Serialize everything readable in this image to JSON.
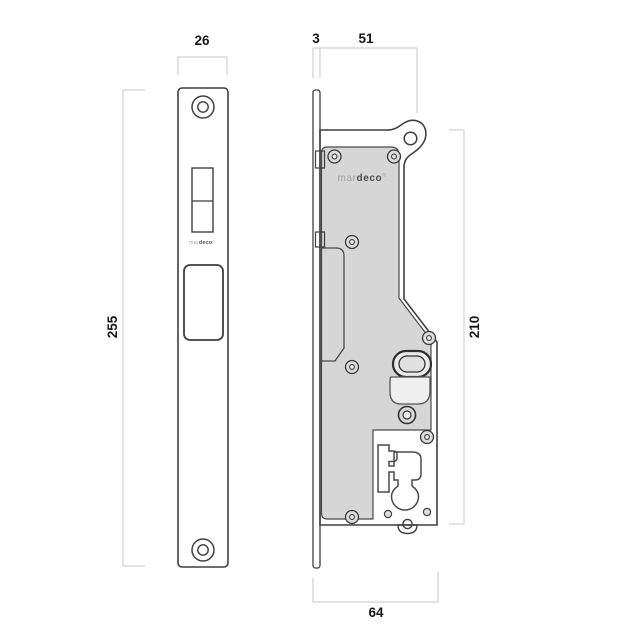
{
  "drawing": {
    "type": "mortice-lock-technical-drawing",
    "views": {
      "front": "faceplate front elevation",
      "side": "lock case side elevation"
    },
    "brand_side": {
      "part1": "mar",
      "part2": "deco",
      "reg": "®"
    },
    "brand_front": {
      "part1": "mar",
      "part2": "deco",
      "reg": "®"
    },
    "dims": {
      "plate_width": "26",
      "plate_height": "255",
      "plate_thickness": "3",
      "case_depth": "51",
      "case_height": "210",
      "total_depth": "64"
    },
    "colors": {
      "background": "#ffffff",
      "plate_fill": "#d3d3d3",
      "case_fill": "#cfcfcf",
      "cover_fill": "#d6d6d6",
      "outline": "#3f3f3f",
      "dimension_line": "#c7c7c7",
      "dimension_text": "#161616",
      "cutout_white": "#ffffff"
    }
  }
}
